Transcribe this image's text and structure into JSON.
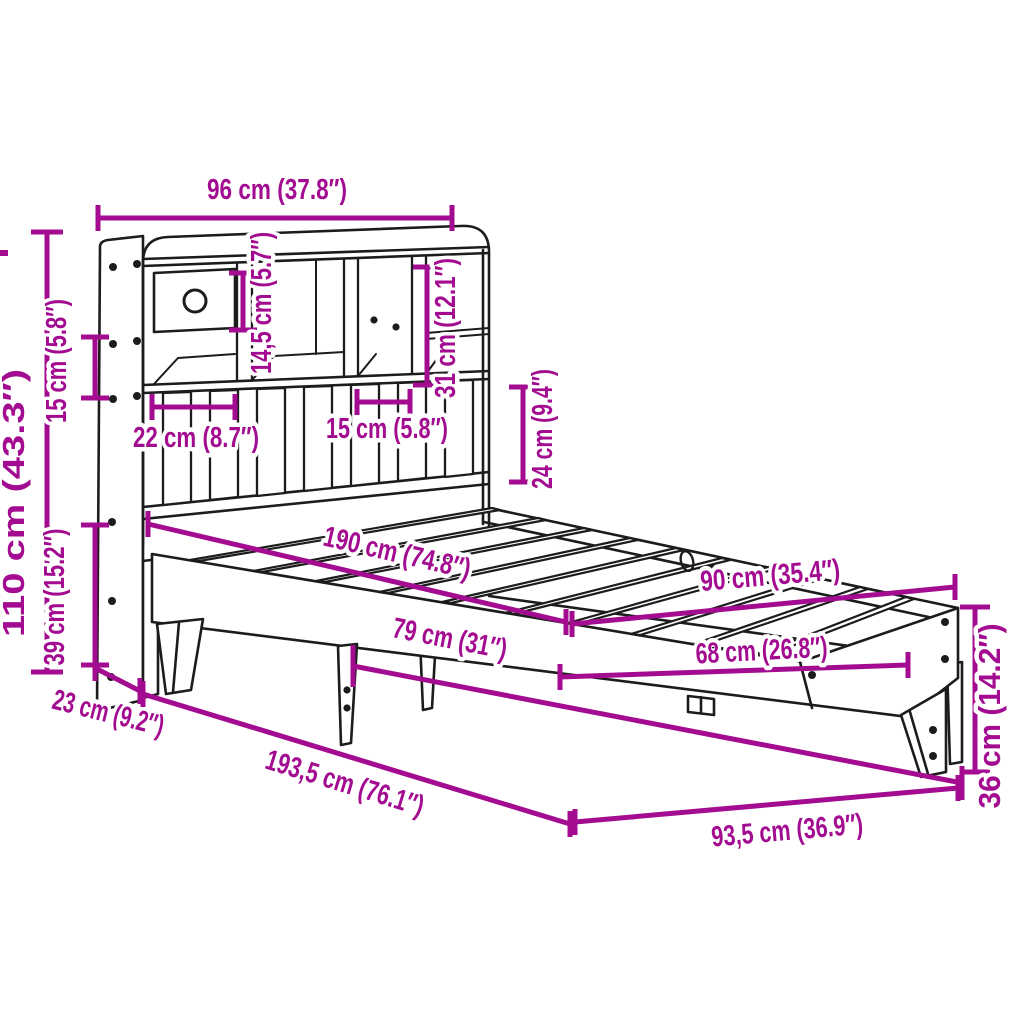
{
  "diagram": {
    "type": "product-dimension-diagram",
    "subject": "bed frame with bookshelf headboard",
    "accent_color": "#A30C90",
    "line_color": "#1C1C1C",
    "background_color": "#FFFFFF",
    "labels": {
      "headboard_width": "96 cm (37.8″)",
      "total_height": "110 cm (43.3″)",
      "shelf_gap_height": "15 cm (5.8″)",
      "underbed_height": "39 cm (15.2″)",
      "compartment_height": "14,5 cm (5.7″)",
      "shelf_total_height": "31 cm (12.1″)",
      "panel_height": "24 cm (9.4″)",
      "compartment_width_large": "22 cm (8.7″)",
      "compartment_width_small": "15 cm (5.8″)",
      "mattress_length": "190 cm (74.8″)",
      "mattress_width": "90 cm (35.4″)",
      "leg_spacing": "79 cm (31″)",
      "side_rail_span": "68 cm (26.8″)",
      "frame_height": "36 cm (14.2″)",
      "headboard_depth": "23 cm (9.2″)",
      "total_length": "193,5 cm (76.1″)",
      "total_width": "93,5 cm (36.9″)"
    }
  }
}
